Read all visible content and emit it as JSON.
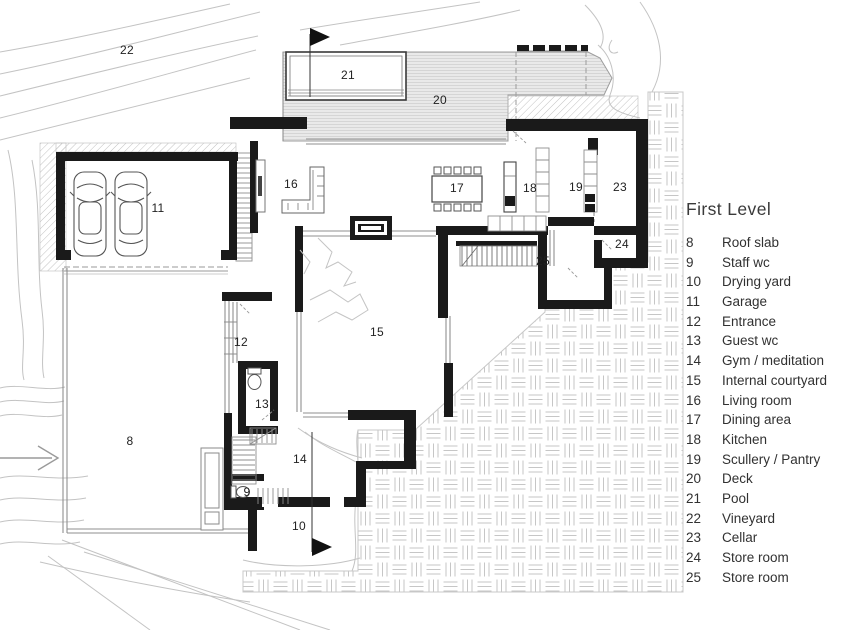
{
  "title": "First Level",
  "legend": {
    "items": [
      {
        "num": "8",
        "label": "Roof slab"
      },
      {
        "num": "9",
        "label": "Staff wc"
      },
      {
        "num": "10",
        "label": "Drying yard"
      },
      {
        "num": "11",
        "label": "Garage"
      },
      {
        "num": "12",
        "label": "Entrance"
      },
      {
        "num": "13",
        "label": "Guest wc"
      },
      {
        "num": "14",
        "label": "Gym / meditation"
      },
      {
        "num": "15",
        "label": "Internal courtyard"
      },
      {
        "num": "16",
        "label": "Living room"
      },
      {
        "num": "17",
        "label": "Dining area"
      },
      {
        "num": "18",
        "label": "Kitchen"
      },
      {
        "num": "19",
        "label": "Scullery / Pantry"
      },
      {
        "num": "20",
        "label": "Deck"
      },
      {
        "num": "21",
        "label": "Pool"
      },
      {
        "num": "22",
        "label": "Vineyard"
      },
      {
        "num": "23",
        "label": "Cellar"
      },
      {
        "num": "24",
        "label": "Store room"
      },
      {
        "num": "25",
        "label": "Store room"
      }
    ]
  },
  "plan": {
    "numbers": {
      "n8": "8",
      "n9": "9",
      "n10": "10",
      "n11": "11",
      "n12": "12",
      "n13": "13",
      "n14": "14",
      "n15": "15",
      "n16": "16",
      "n17": "17",
      "n18": "18",
      "n19": "19",
      "n20": "20",
      "n21": "21",
      "n22": "22",
      "n23": "23",
      "n24": "24",
      "n25": "25"
    }
  },
  "colors": {
    "ink": "#1a1a1a",
    "thin_line": "#8f8f8f",
    "contour": "#c3c3c3",
    "deck_fill": "#e9e9e9",
    "pattern_line": "#c6c6c6"
  }
}
